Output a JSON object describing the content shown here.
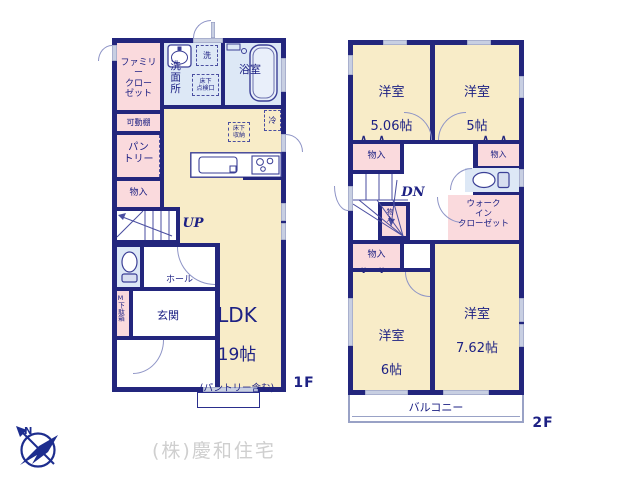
{
  "floor1": {
    "floor_label": "1F",
    "family_closet": "ファミリー\nクロー\nゼット",
    "washroom": "洗面所",
    "washer": "洗",
    "bathroom": "浴室",
    "underfloor_hatch": "床下\n点検口",
    "movable_shelf": "可動棚",
    "pantry": "パン\nトリー",
    "storage": "物入",
    "up": "UP",
    "hall": "ホール",
    "shoe_box": "M下駄箱",
    "entrance": "玄関",
    "ldk_name": "LDK",
    "ldk_size": "19帖",
    "ldk_note": "(パントリー含む)",
    "underfloor_storage": "床下\n収納",
    "fridge": "冷"
  },
  "floor2": {
    "floor_label": "2F",
    "bedroom1_name": "洋室",
    "bedroom1_size": "5.06帖",
    "bedroom2_name": "洋室",
    "bedroom2_size": "5帖",
    "bedroom3_name": "洋室",
    "bedroom3_size": "6帖",
    "bedroom4_name": "洋室",
    "bedroom4_size": "7.62帖",
    "storage_top_left": "物入",
    "storage_right": "物入",
    "storage_small": "物入",
    "storage_bottom_left": "物入",
    "dn": "DN",
    "walk_in_closet": "ウォーク\nイン\nクローゼット",
    "balcony": "バルコニー"
  },
  "footer": {
    "company": "(株)慶和住宅",
    "compass_n": "N"
  },
  "colors": {
    "wall": "#23267d",
    "room_cream": "#f8ecc8",
    "room_pink": "#fadadd",
    "room_blue": "#dde8f6",
    "window": "#c8cfe2",
    "watermark": "#cfcfcf"
  }
}
